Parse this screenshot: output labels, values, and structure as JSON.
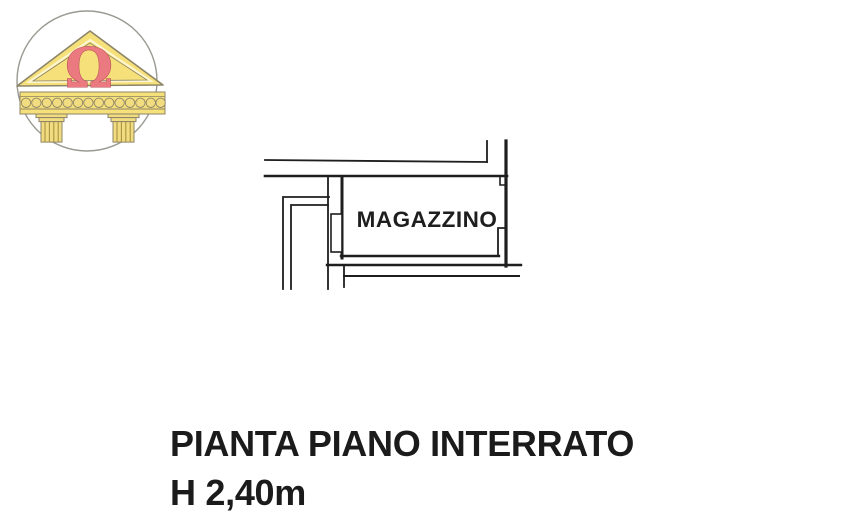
{
  "page": {
    "background": "#ffffff",
    "type_label": "scanned floor plan page"
  },
  "logo": {
    "symbol": "Ω",
    "colors": {
      "circle_stroke": "#9a9a92",
      "pediment_fill": "#f6e07a",
      "pediment_stroke": "#8d8568",
      "inner_gap": "#fdf6d2",
      "omega_fill": "#ea7a80",
      "omega_stroke": "#b84e56",
      "column_fill": "#f2dc80",
      "column_stroke": "#8d8568",
      "flute_stroke": "#a89143"
    }
  },
  "plan": {
    "room_label": "MAGAZZINO",
    "wall_color": "#1e1e1e"
  },
  "caption": {
    "line1": "PIANTA PIANO INTERRATO",
    "line2": "H 2,40m",
    "text_color": "#1b1b1b"
  }
}
